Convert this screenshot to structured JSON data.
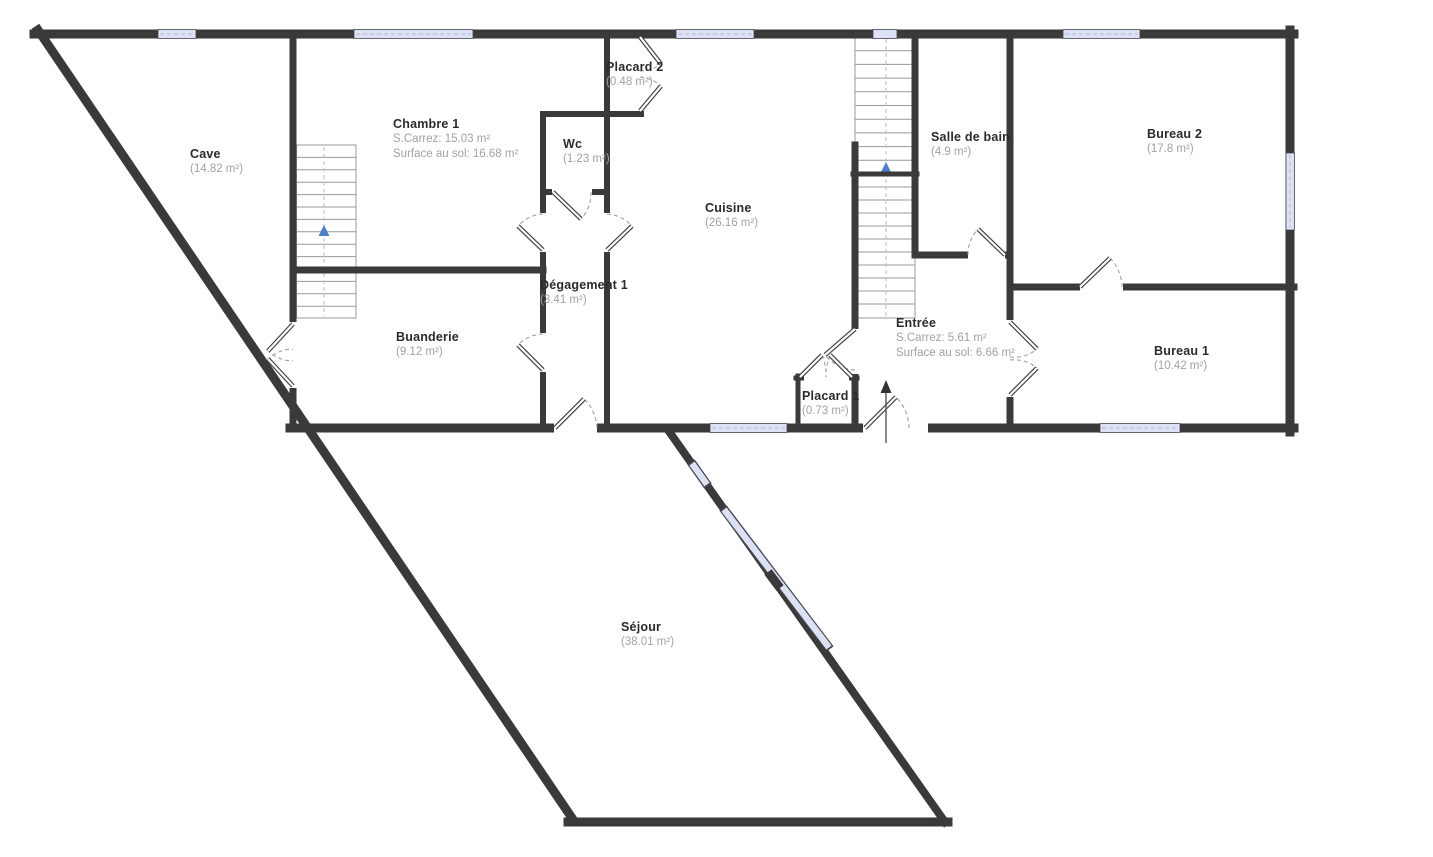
{
  "title": "Floor plan",
  "colors": {
    "wall": "#3a3a3a",
    "window_fill": "#dde1f4",
    "window_edge": "#45454f",
    "stair_line": "#999999",
    "stair_guide": "#a9bfdf",
    "stair_arrow": "#4d7ec9",
    "door_arc": "#9a9a9a",
    "door_leaf_edge": "#3f3f3f",
    "label_name": "#2b2b2b",
    "label_sub": "#a2a2a2",
    "background": "#ffffff"
  },
  "rooms": [
    {
      "name": "Cave",
      "sub1": "(14.82 m²)",
      "sub2": ""
    },
    {
      "name": "Chambre 1",
      "sub1": "S.Carrez: 15.03 m²",
      "sub2": "Surface au sol: 16.68 m²"
    },
    {
      "name": "Placard 2",
      "sub1": "(0.48 m²)",
      "sub2": ""
    },
    {
      "name": "Wc",
      "sub1": "(1.23 m²)",
      "sub2": ""
    },
    {
      "name": "Cuisine",
      "sub1": "(26.16 m²)",
      "sub2": ""
    },
    {
      "name": "Salle de bain",
      "sub1": "(4.9 m²)",
      "sub2": ""
    },
    {
      "name": "Bureau 2",
      "sub1": "(17.8 m²)",
      "sub2": ""
    },
    {
      "name": "Dégagement 1",
      "sub1": "(3.41 m²)",
      "sub2": ""
    },
    {
      "name": "Buanderie",
      "sub1": "(9.12 m²)",
      "sub2": ""
    },
    {
      "name": "Entrée",
      "sub1": "S.Carrez: 5.61 m²",
      "sub2": "Surface au sol: 6.66 m²"
    },
    {
      "name": "Placard 1",
      "sub1": "(0.73 m²)",
      "sub2": ""
    },
    {
      "name": "Bureau 1",
      "sub1": "(10.42 m²)",
      "sub2": ""
    },
    {
      "name": "Séjour",
      "sub1": "(38.01 m²)",
      "sub2": ""
    }
  ]
}
